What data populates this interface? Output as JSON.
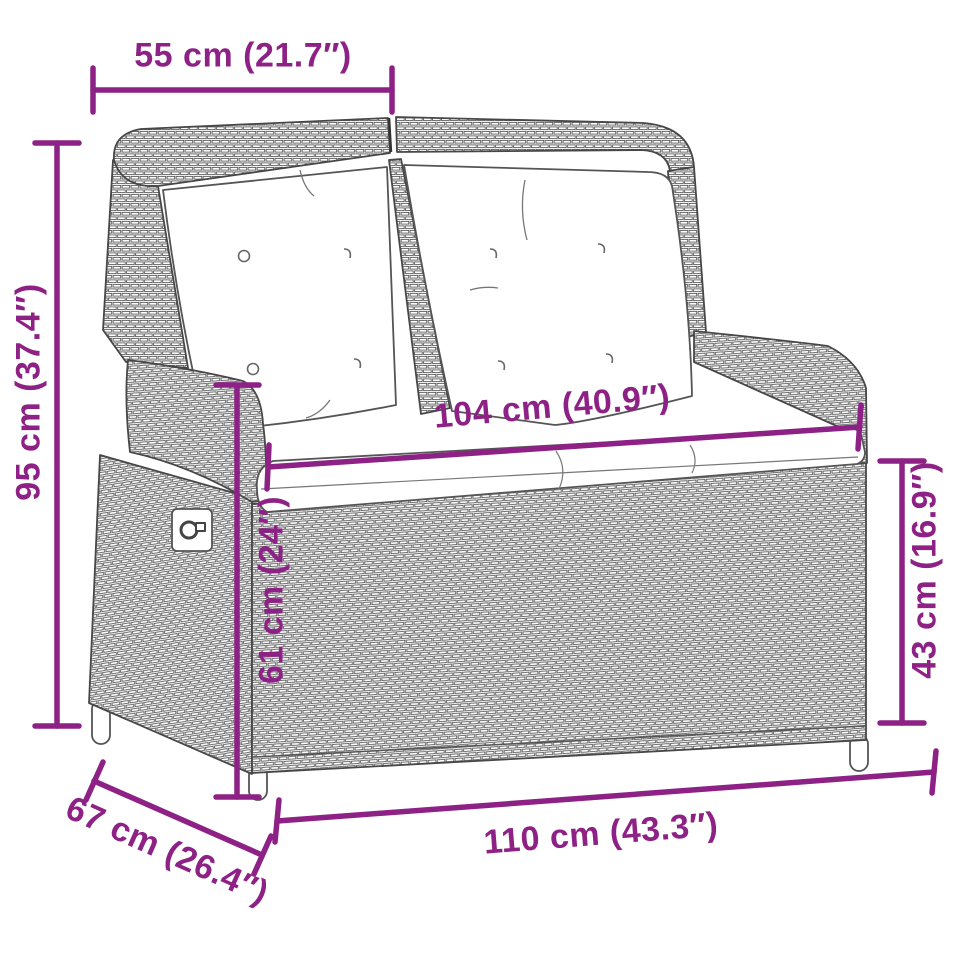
{
  "diagram": {
    "type": "product-dimension-diagram",
    "subject": "reclining poly rattan garden bench with cushions",
    "background_color": "#ffffff",
    "accent_color": "#8D2186",
    "outline_color": "#4a4a4a",
    "dimensions": {
      "top_back_width": "55 cm (21.7″)",
      "overall_height": "95 cm (37.4″)",
      "seat_width": "104 cm (40.9″)",
      "backrest_height": "61 cm (24″)",
      "seat_height": "43 cm (16.9″)",
      "overall_width": "110 cm (43.3″)",
      "overall_depth": "67 cm (26.4″)"
    }
  }
}
